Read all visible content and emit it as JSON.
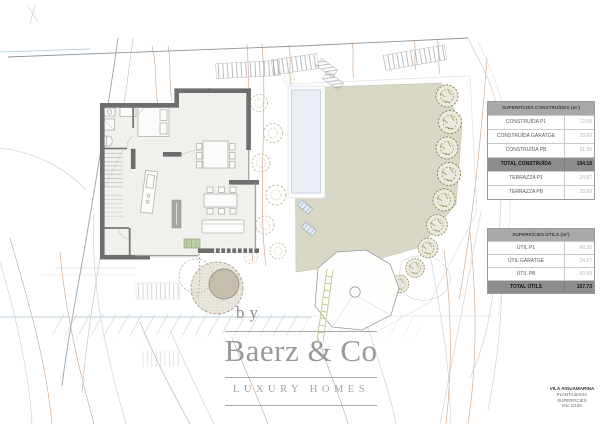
{
  "document": {
    "kind": "architectural site plan, ground floor (planta baixa)"
  },
  "tables": {
    "construides": {
      "header": "SUPERFÍCIES CONSTRUÏDES (m²)",
      "rows": [
        {
          "label": "CONSTRUÏDA P1",
          "value": "72.68"
        },
        {
          "label": "CONSTRUÏDA GARATGE",
          "value": "29.60"
        },
        {
          "label": "CONSTRUÏDA PB",
          "value": "91.90"
        },
        {
          "label": "TOTAL CONSTRUÏDA",
          "value": "194.18"
        },
        {
          "label": "TERRAZZA P1",
          "value": "24.87"
        },
        {
          "label": "TERRAZZA PB",
          "value": "29.88"
        }
      ]
    },
    "utils": {
      "header": "SUPERFÍCIES ÚTILS (m²)",
      "rows": [
        {
          "label": "ÚTIL P1",
          "value": "49.38"
        },
        {
          "label": "ÚTIL GARATGE",
          "value": "24.67"
        },
        {
          "label": "ÚTIL PB",
          "value": "83.68"
        },
        {
          "label": "TOTAL ÚTILS",
          "value": "157.73"
        }
      ]
    }
  },
  "watermark": {
    "by": "by",
    "brand": "Baerz & Co",
    "tagline": "LUXURY HOMES"
  },
  "titleblock": {
    "project": "VILA AIGUAMARINA",
    "plan": "PLANTA BAIXA",
    "sheet": "SUPERFICIES",
    "scale": "Esc 1/100"
  },
  "colors": {
    "wall": "#6e6e6e",
    "lawn": "#d9d8c6",
    "pool": "#e9eef5",
    "tree": "#8f905c",
    "contour_tan": "#c9a183",
    "boundary_red_dashed": "#b06055",
    "waterline_blue": "#b8cddb",
    "table_header_bg": "#a9a9a9",
    "table_total_bg": "#8d8d8d"
  }
}
